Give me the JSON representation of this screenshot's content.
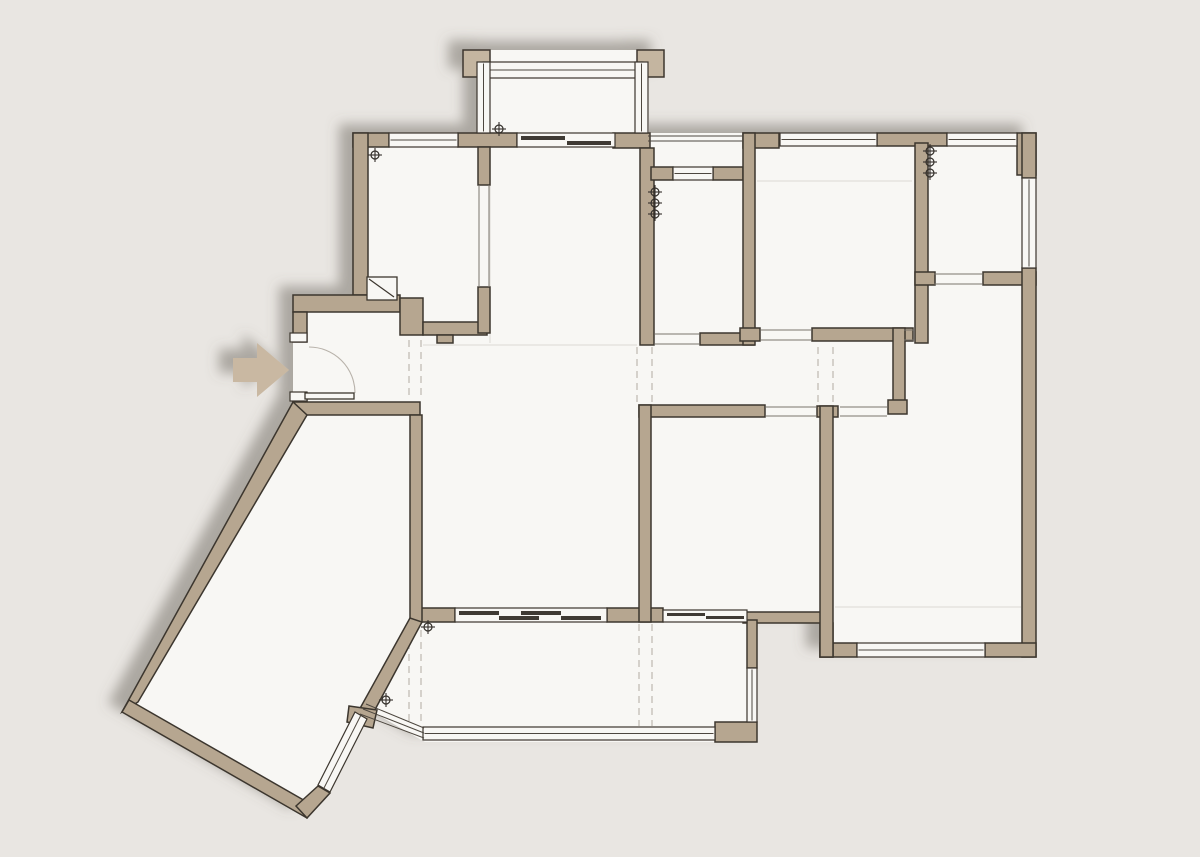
{
  "canvas": {
    "width": 1200,
    "height": 857
  },
  "palette": {
    "background": "#e9e6e2",
    "floor": "#f8f7f4",
    "wall": "#b6a690",
    "wall_light": "#c4b5a0",
    "outline": "#3c362e",
    "window_line": "#4d473f",
    "panel": "#3f3a34",
    "dashed": "#c6c1ba",
    "faint": "#e2dfda",
    "opening": "#7a746c",
    "arrow": "#c9b8a2",
    "marker": "#332f2a",
    "arc": "#b8b2aa",
    "shadow": "#6e6861"
  },
  "plan": {
    "shadow": {
      "dx": -14,
      "dy": -9,
      "blur": 6,
      "opacity": 0.5
    },
    "silhouette": "353,133 477,133 477,50 649,50 649,133 1036,133 1036,657 820,657 820,623 757,623 757,742 425,742 371,711 305,818 122,712 293,402 293,295 353,295",
    "entry_arrow": "233,358 257,358 257,343 289,370 257,397 257,382 233,382",
    "shadow_piers": [
      [
        463,
        50,
        27,
        27
      ],
      [
        637,
        50,
        27,
        27
      ]
    ],
    "walls": [
      [
        353,
        133,
        36,
        14
      ],
      [
        458,
        133,
        59,
        14
      ],
      [
        613,
        133,
        37,
        15
      ],
      [
        743,
        133,
        36,
        15
      ],
      [
        877,
        133,
        70,
        13
      ],
      [
        1017,
        133,
        19,
        42
      ],
      [
        353,
        133,
        15,
        162
      ],
      [
        293,
        295,
        107,
        17
      ],
      [
        293,
        312,
        14,
        30
      ],
      [
        293,
        393,
        14,
        11
      ],
      [
        293,
        402,
        127,
        13
      ],
      [
        400,
        298,
        23,
        37
      ],
      [
        423,
        322,
        64,
        13
      ],
      [
        437,
        335,
        16,
        8
      ],
      [
        478,
        147,
        12,
        38
      ],
      [
        478,
        287,
        12,
        46
      ],
      [
        640,
        148,
        14,
        197
      ],
      [
        700,
        333,
        54,
        12
      ],
      [
        651,
        167,
        22,
        13
      ],
      [
        713,
        167,
        30,
        13
      ],
      [
        743,
        133,
        12,
        212
      ],
      [
        740,
        328,
        20,
        13
      ],
      [
        812,
        328,
        101,
        13
      ],
      [
        893,
        328,
        12,
        80
      ],
      [
        888,
        400,
        19,
        14
      ],
      [
        915,
        143,
        13,
        200
      ],
      [
        915,
        272,
        20,
        13
      ],
      [
        983,
        272,
        53,
        13
      ],
      [
        1022,
        133,
        14,
        45
      ],
      [
        1022,
        268,
        14,
        389
      ],
      [
        820,
        643,
        37,
        14
      ],
      [
        985,
        643,
        51,
        14
      ],
      [
        820,
        623,
        13,
        34
      ],
      [
        743,
        612,
        79,
        11
      ],
      [
        420,
        608,
        35,
        14
      ],
      [
        607,
        608,
        56,
        14
      ],
      [
        747,
        620,
        10,
        48
      ],
      [
        715,
        722,
        42,
        20
      ],
      [
        639,
        405,
        126,
        12
      ],
      [
        817,
        406,
        21,
        11
      ],
      [
        639,
        405,
        12,
        217
      ],
      [
        820,
        406,
        13,
        251
      ],
      [
        410,
        415,
        12,
        207
      ]
    ],
    "wall_polys": [
      "293,402 122,712 138,702 307,415",
      "122,712 307,818 314,806 129,700",
      "410,618 358,712 370,719 422,622",
      "349,706 377,710 373,728 347,722",
      "318,786 330,793 307,818 296,806"
    ],
    "windows_h": [
      [
        389,
        133,
        69,
        14
      ],
      [
        483,
        62,
        160,
        16
      ],
      [
        780,
        133,
        97,
        13
      ],
      [
        947,
        133,
        70,
        13
      ],
      [
        673,
        167,
        40,
        13
      ],
      [
        857,
        643,
        128,
        14
      ],
      [
        423,
        727,
        292,
        13
      ]
    ],
    "windows_v": [
      [
        477,
        62,
        13,
        71
      ],
      [
        635,
        62,
        13,
        71
      ],
      [
        1022,
        178,
        14,
        90
      ],
      [
        747,
        668,
        10,
        54
      ]
    ],
    "window_poly": {
      "points": "355,712 367,719 330,792 318,785",
      "line": [
        361,
        715,
        324,
        788
      ]
    },
    "extra_window_lines": [
      [
        648,
        136,
        743,
        136
      ],
      [
        648,
        141,
        743,
        141
      ],
      [
        366,
        704,
        424,
        728
      ],
      [
        363,
        709,
        424,
        733
      ],
      [
        360,
        714,
        424,
        738
      ]
    ],
    "slider_bands": [
      [
        517,
        133,
        98,
        14
      ],
      [
        455,
        608,
        152,
        14
      ],
      [
        663,
        610,
        84,
        12
      ]
    ],
    "slider_panels": [
      [
        521,
        136,
        44,
        4
      ],
      [
        567,
        141,
        44,
        4
      ],
      [
        459,
        611,
        40,
        4
      ],
      [
        499,
        616,
        40,
        4
      ],
      [
        521,
        611,
        40,
        4
      ],
      [
        561,
        616,
        40,
        4
      ],
      [
        667,
        613,
        38,
        3
      ],
      [
        706,
        616,
        38,
        3
      ]
    ],
    "opening_lines": [
      [
        479,
        185,
        479,
        287
      ],
      [
        489,
        185,
        489,
        287
      ],
      [
        655,
        334,
        699,
        334
      ],
      [
        655,
        344,
        699,
        344
      ],
      [
        761,
        330,
        811,
        330
      ],
      [
        761,
        340,
        811,
        340
      ],
      [
        934,
        274,
        982,
        274
      ],
      [
        934,
        284,
        982,
        284
      ],
      [
        766,
        407,
        816,
        407
      ],
      [
        766,
        416,
        816,
        416
      ],
      [
        840,
        407,
        887,
        407
      ],
      [
        840,
        416,
        887,
        416
      ],
      [
        904,
        330,
        914,
        330
      ],
      [
        904,
        340,
        914,
        340
      ]
    ],
    "caps": [
      [
        290,
        333,
        17,
        9
      ],
      [
        290,
        392,
        17,
        9
      ]
    ],
    "dashed_lines": [
      [
        409,
        340,
        409,
        400
      ],
      [
        421,
        340,
        421,
        400
      ],
      [
        637,
        347,
        637,
        403
      ],
      [
        652,
        347,
        652,
        403
      ],
      [
        818,
        347,
        818,
        403
      ],
      [
        833,
        347,
        833,
        403
      ],
      [
        639,
        624,
        639,
        726
      ],
      [
        652,
        624,
        652,
        726
      ],
      [
        409,
        630,
        409,
        724
      ],
      [
        421,
        630,
        421,
        724
      ]
    ],
    "faint_lines": [
      [
        757,
        181,
        912,
        181
      ],
      [
        835,
        607,
        1021,
        607
      ],
      [
        423,
        345,
        637,
        345
      ],
      [
        490,
        150,
        490,
        343
      ]
    ],
    "markers": [
      [
        499,
        129
      ],
      [
        375,
        155
      ],
      [
        655,
        192
      ],
      [
        655,
        203
      ],
      [
        655,
        214
      ],
      [
        930,
        151
      ],
      [
        930,
        162
      ],
      [
        930,
        173
      ],
      [
        428,
        627
      ],
      [
        386,
        700
      ]
    ],
    "entry_door": {
      "leaf": [
        305,
        393,
        49,
        6
      ],
      "arc": "M 309,347 A 46 46 0 0 1 355,393"
    },
    "niche": {
      "rect": [
        367,
        277,
        30,
        23
      ],
      "line": [
        369,
        279,
        394,
        297
      ]
    }
  }
}
